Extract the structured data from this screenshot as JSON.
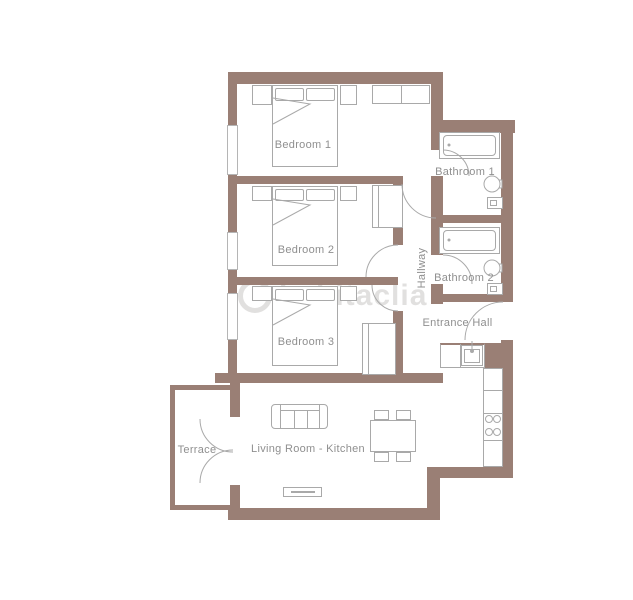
{
  "plan": {
    "title": "Apartment floor plan",
    "watermark": "habitaclia",
    "colors": {
      "wall": "#9a7f75",
      "furniture_line": "#a9a9a9",
      "label_text": "#8f8f8f",
      "background": "#ffffff"
    },
    "rooms": {
      "bedroom1": {
        "label": "Bedroom 1"
      },
      "bedroom2": {
        "label": "Bedroom 2"
      },
      "bedroom3": {
        "label": "Bedroom 3"
      },
      "bathroom1": {
        "label": "Bathroom 1"
      },
      "bathroom2": {
        "label": "Bathroom 2"
      },
      "hallway": {
        "label": "Hallway"
      },
      "entrance_hall": {
        "label": "Entrance Hall"
      },
      "terrace": {
        "label": "Terrace"
      },
      "living_room_kitchen": {
        "label": "Living Room - Kitchen"
      }
    }
  }
}
